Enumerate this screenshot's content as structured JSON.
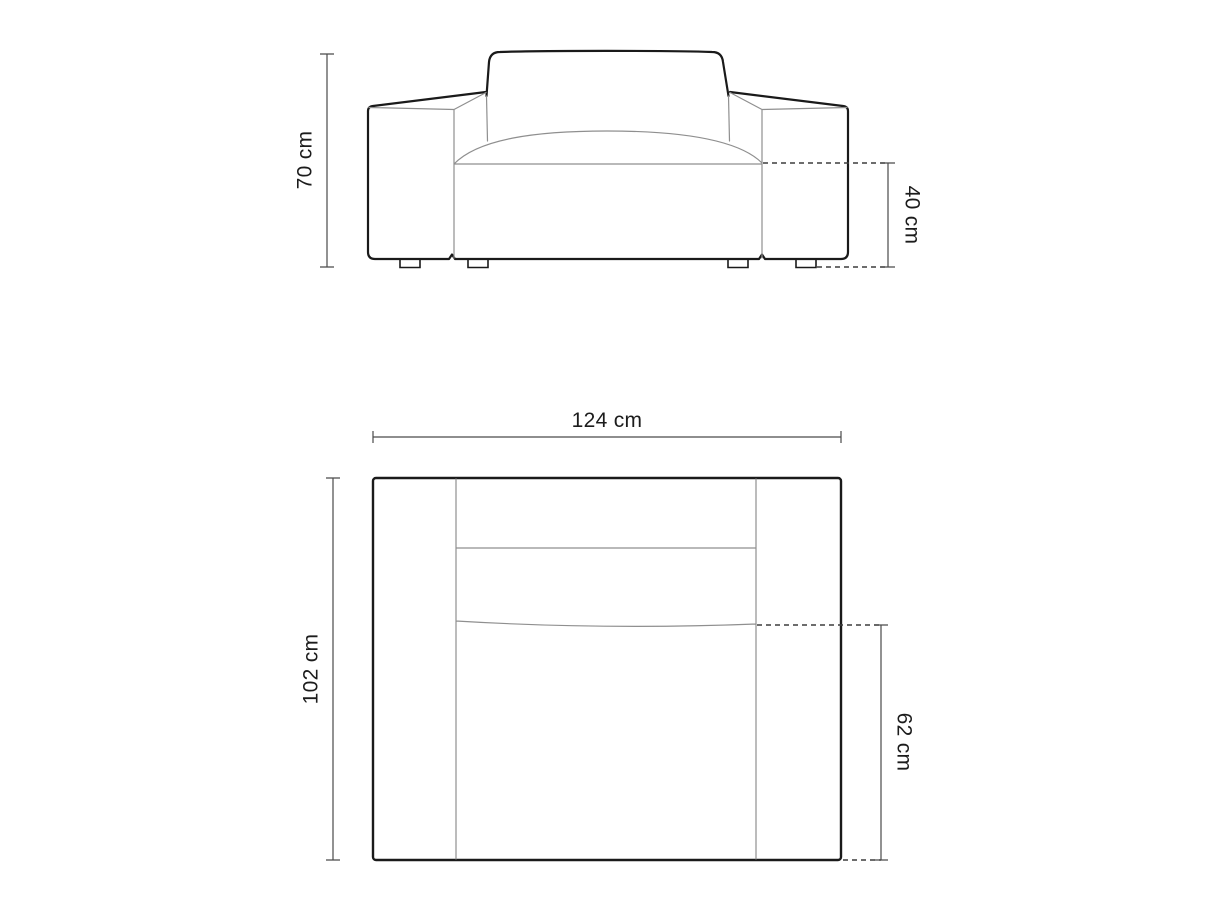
{
  "diagram": {
    "views": {
      "front": {
        "dimensions": {
          "height": "70 cm",
          "seat_height": "40 cm"
        }
      },
      "plan": {
        "dimensions": {
          "width": "124 cm",
          "depth": "102 cm",
          "seat_depth": "62 cm"
        }
      }
    },
    "colors": {
      "background": "#ffffff",
      "outline": "#1a1a1a",
      "detail_line": "#8f8f8f",
      "dimension_line": "#4a4a4a",
      "dashed_line": "#3d3d3d",
      "label_text": "#1c1c1c"
    }
  }
}
